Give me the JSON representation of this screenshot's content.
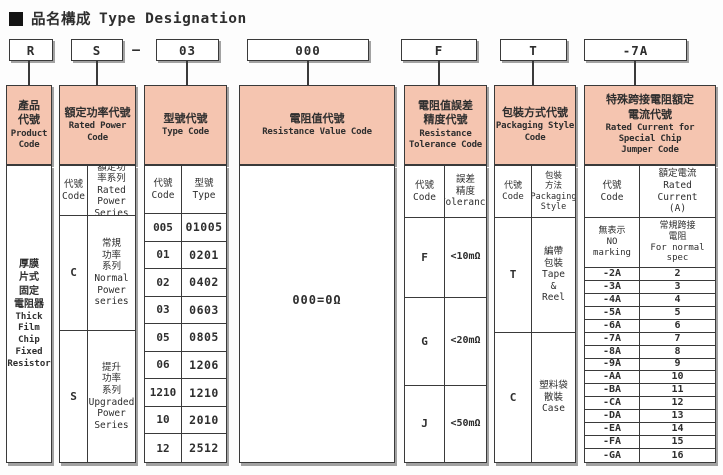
{
  "title": {
    "marker": "■",
    "cjk": "品名構成",
    "en": "Type Designation"
  },
  "top_row": {
    "codes": [
      "R",
      "S",
      "03",
      "000",
      "F",
      "T",
      "-7A"
    ],
    "separator": "—"
  },
  "columns": {
    "product": {
      "header_cjk": "產品\n代號",
      "header_en": "Product\nCode",
      "body_cjk": "厚膜\n片式\n固定\n電阻器",
      "body_en": "Thick\nFilm\nChip\nFixed\nResistor"
    },
    "power": {
      "header_cjk": "額定功率代號",
      "header_en": "Rated Power\nCode",
      "code_label": "代號\nCode",
      "series_label": "額定功\n率系列\nRated\nPower\nSeries",
      "rows": [
        {
          "code": "C",
          "desc": "常規\n功率\n系列\nNormal\nPower\nseries"
        },
        {
          "code": "S",
          "desc": "提升\n功率\n系列\nUpgraded\nPower\nSeries"
        }
      ]
    },
    "type": {
      "header_cjk": "型號代號",
      "header_en": "Type Code",
      "code_label": "代號\nCode",
      "type_label": "型號\nType",
      "rows": [
        {
          "code": "005",
          "type": "01005"
        },
        {
          "code": "01",
          "type": "0201"
        },
        {
          "code": "02",
          "type": "0402"
        },
        {
          "code": "03",
          "type": "0603"
        },
        {
          "code": "05",
          "type": "0805"
        },
        {
          "code": "06",
          "type": "1206"
        },
        {
          "code": "1210",
          "type": "1210"
        },
        {
          "code": "10",
          "type": "2010"
        },
        {
          "code": "12",
          "type": "2512"
        }
      ]
    },
    "resistance": {
      "header_cjk": "電阻值代號",
      "header_en": "Resistance Value Code",
      "value": "000=0Ω"
    },
    "tolerance": {
      "header_cjk": "電阻值誤差\n精度代號",
      "header_en": "Resistance\nTolerance Code",
      "code_label": "代號\nCode",
      "tol_label": "誤差\n精度\nTolerance",
      "rows": [
        {
          "code": "F",
          "tol": "<10mΩ"
        },
        {
          "code": "G",
          "tol": "<20mΩ"
        },
        {
          "code": "J",
          "tol": "<50mΩ"
        }
      ]
    },
    "packaging": {
      "header_cjk": "包裝方式代號",
      "header_en": "Packaging Style\nCode",
      "code_label": "代號\nCode",
      "style_label": "包裝\n方法\nPackaging\nStyle",
      "rows": [
        {
          "code": "T",
          "desc": "編帶\n包裝\nTape\n&\nReel"
        },
        {
          "code": "C",
          "desc": "塑料袋\n散裝\nCase"
        }
      ]
    },
    "jumper": {
      "header_cjk": "特殊跨接電阻額定\n電流代號",
      "header_en": "Rated Current for\nSpecial Chip\nJumper Code",
      "code_label": "代號\nCode",
      "current_label": "額定電流\nRated\nCurrent\n(A)",
      "special": {
        "code": "無表示\nNO\nmarking",
        "desc": "常規跨接\n電阻\nFor normal\nspec"
      },
      "rows": [
        {
          "code": "-2A",
          "amps": "2"
        },
        {
          "code": "-3A",
          "amps": "3"
        },
        {
          "code": "-4A",
          "amps": "4"
        },
        {
          "code": "-5A",
          "amps": "5"
        },
        {
          "code": "-6A",
          "amps": "6"
        },
        {
          "code": "-7A",
          "amps": "7"
        },
        {
          "code": "-8A",
          "amps": "8"
        },
        {
          "code": "-9A",
          "amps": "9"
        },
        {
          "code": "-AA",
          "amps": "10"
        },
        {
          "code": "-BA",
          "amps": "11"
        },
        {
          "code": "-CA",
          "amps": "12"
        },
        {
          "code": "-DA",
          "amps": "13"
        },
        {
          "code": "-EA",
          "amps": "14"
        },
        {
          "code": "-FA",
          "amps": "15"
        },
        {
          "code": "-GA",
          "amps": "16"
        }
      ]
    }
  },
  "colors": {
    "header_bg": "#f5c5b0",
    "border": "#3a3a3a",
    "shadow": "#a2a2a2"
  }
}
